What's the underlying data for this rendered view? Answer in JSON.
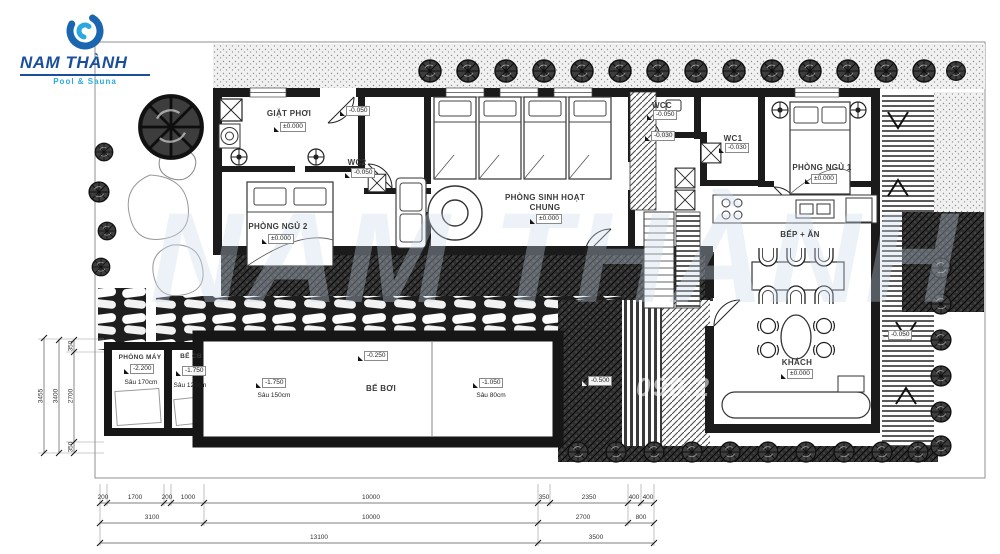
{
  "logo": {
    "title": "NAM THÀNH",
    "tagline": "Pool & Sauna"
  },
  "watermark": {
    "brand": "NAM THÀNH",
    "phone": "090.2"
  },
  "rooms": {
    "giat_phoi": {
      "label": "GIẶT PHƠI",
      "elev": "±0.000"
    },
    "wc2": {
      "label": "WC2",
      "elev": "-0.050"
    },
    "phong_ngu_2": {
      "label": "PHÒNG NGỦ 2",
      "elev": "±0.000"
    },
    "sinh_hoat_chung": {
      "label": "PHÒNG SINH HOẠT CHUNG",
      "elev": "±0.000"
    },
    "wcc": {
      "label": "WCC",
      "elev": "-0.050"
    },
    "wc1": {
      "label": "WC1",
      "elev": "-0.030"
    },
    "phong_ngu_1": {
      "label": "PHÒNG NGỦ 1",
      "elev": "±0.000"
    },
    "bep_an": {
      "label": "BẾP + ĂN"
    },
    "khach": {
      "label": "KHÁCH",
      "elev": "±0.000"
    },
    "phong_may": {
      "label": "PHÒNG MÁY",
      "elev": "-2.200",
      "depth": "Sâu 170cm"
    },
    "be_cb": {
      "label": "BỂ CB",
      "elev": "-1.750",
      "depth": "Sâu 120cm"
    },
    "be_boi": {
      "label": "BỂ BƠI"
    }
  },
  "markers": {
    "door_entry": "-0.050",
    "hall": "-0.030",
    "pool_edge": "-0.250",
    "pool_shallow": {
      "elev": "-1.750",
      "depth": "Sâu 150cm"
    },
    "pool_deep": {
      "elev": "-1.050",
      "depth": "Sâu 80cm"
    },
    "deck": "-0.500",
    "terrace": "-0.050"
  },
  "dimensions": {
    "bottom_row1": [
      "200",
      "1700",
      "200",
      "1000",
      "10000",
      "350",
      "2350",
      "400",
      "400"
    ],
    "bottom_row2": [
      "3100",
      "10000",
      "2700",
      "800"
    ],
    "bottom_row3": [
      "13100",
      "3500"
    ],
    "left_col": [
      "3455",
      "3400",
      "2700",
      "350",
      "350"
    ]
  }
}
